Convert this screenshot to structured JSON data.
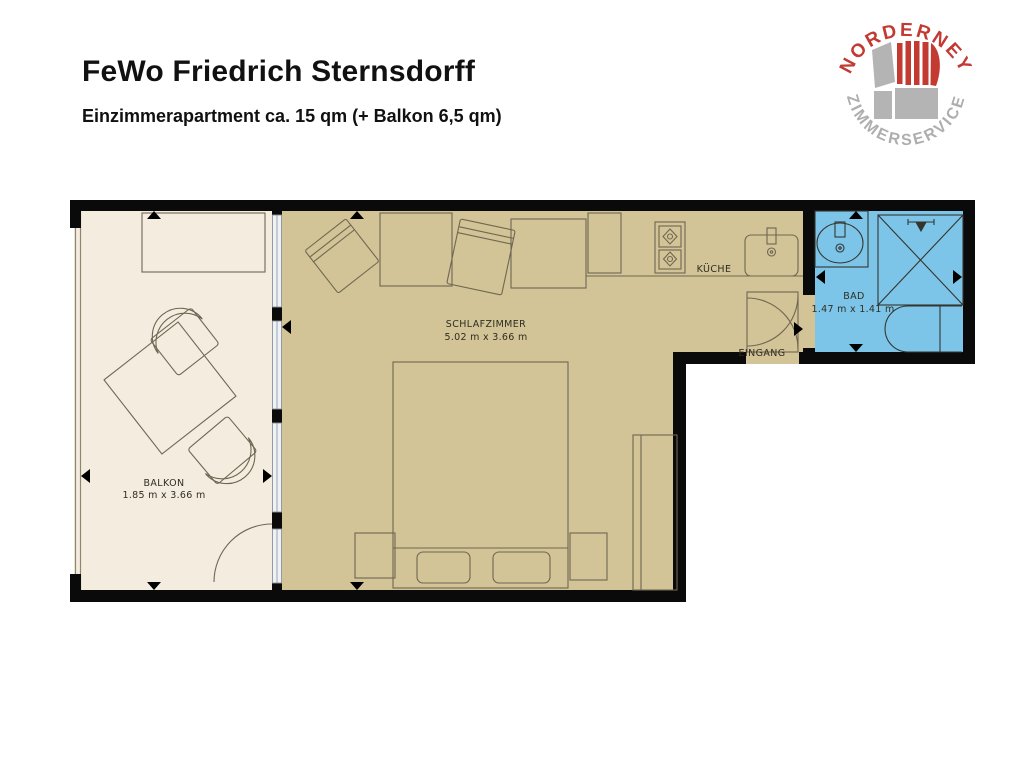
{
  "header": {
    "title": "FeWo Friedrich Sternsdorff",
    "subtitle": "Einzimmerapartment ca. 15 qm (+ Balkon 6,5 qm)"
  },
  "logo": {
    "top_text": "NORDERNEY",
    "bottom_text": "ZIMMERSERVICE",
    "red": "#c23a32",
    "gray": "#aeaeae"
  },
  "floorplan": {
    "wall_color": "#0a0a0a",
    "furniture_line_color": "#6e6753",
    "rooms": [
      {
        "id": "balkon",
        "label": "BALKON",
        "dimensions": "1.85 m x 3.66 m",
        "floor_color": "#f4ecdf"
      },
      {
        "id": "schlafzimmer",
        "label": "SCHLAFZIMMER",
        "dimensions": "5.02 m x 3.66 m",
        "floor_color": "#d2c496"
      },
      {
        "id": "kueche",
        "label": "KÜCHE",
        "floor_color": "#d2c496"
      },
      {
        "id": "eingang",
        "label": "EINGANG"
      },
      {
        "id": "bad",
        "label": "BAD",
        "dimensions": "1.47 m x 1.41 m",
        "floor_color": "#7cc5e8"
      }
    ]
  }
}
